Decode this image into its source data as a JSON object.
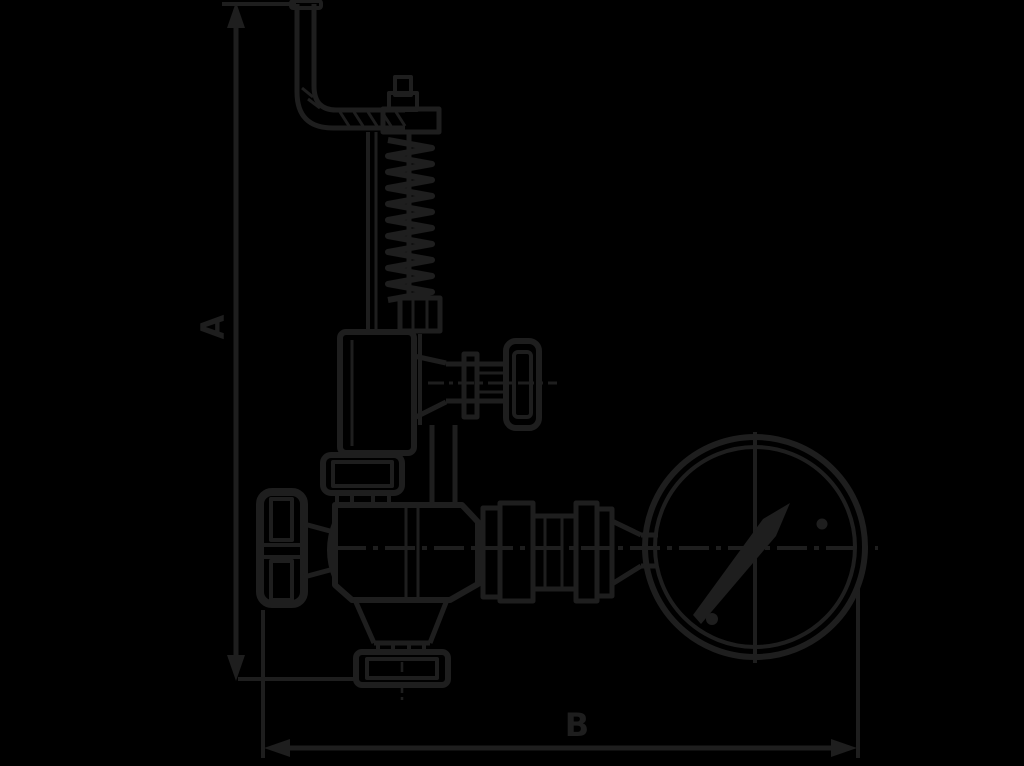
{
  "page": {
    "background_color": "#000000",
    "line_color": "#1e1e1e"
  },
  "diagram": {
    "type": "technical-line-drawing",
    "subject": "spring-loaded safety valve with lifting lever, hand-wheel valves and pressure gauge",
    "dimension_labels": {
      "vertical": "A",
      "horizontal": "B"
    },
    "components": [
      "dimension-line-a",
      "dimension-line-b",
      "lifting-lever",
      "spring-column",
      "spring-bonnet",
      "bonnet-flange",
      "side-branch-valve",
      "side-handwheel",
      "valve-body",
      "inlet-handwheel",
      "outlet-flange",
      "gauge-connection-fittings",
      "pressure-gauge",
      "gauge-needle"
    ]
  }
}
